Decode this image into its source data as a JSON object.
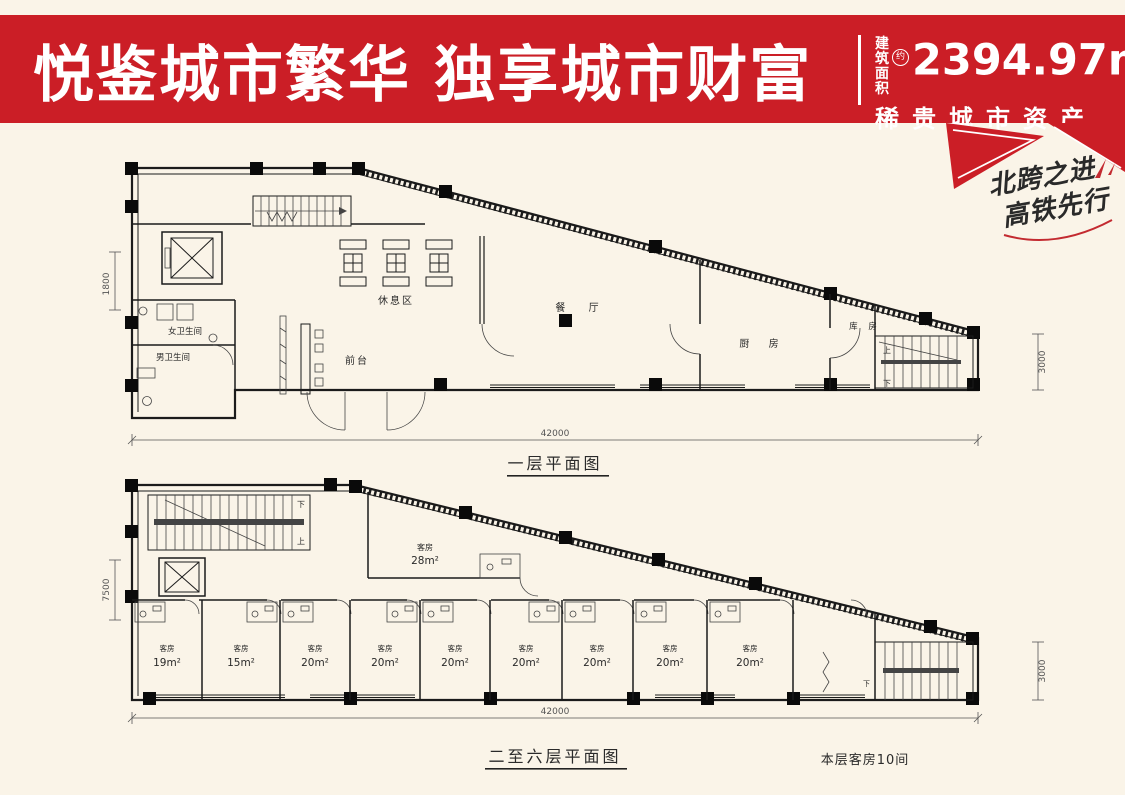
{
  "page": {
    "background": "#faf4e8"
  },
  "header": {
    "background": "#cb1e26",
    "title": "悦鉴城市繁华 独享城市财富",
    "area_label_top": "建筑",
    "area_label_bottom": "面积",
    "area_approx_badge": "约",
    "area_value": "2394.97m",
    "area_exponent": "2",
    "tagline": "稀贵城市资产"
  },
  "ribbon": {
    "color": "#c32a30",
    "line1": "北跨之进",
    "line2": "高铁先行"
  },
  "plan1": {
    "caption": "一层平面图",
    "dim_bottom": "42000",
    "dim_left": "1800",
    "dim_right": "3000",
    "labels": {
      "rest_area": "休息区",
      "dining": "餐 厅",
      "kitchen": "厨 房",
      "storage": "库 房",
      "front_desk": "前台",
      "women_wc": "女卫生间",
      "men_wc": "男卫生间",
      "up": "上",
      "down": "下"
    }
  },
  "plan2": {
    "caption": "二至六层平面图",
    "note": "本层客房10间",
    "dim_bottom": "42000",
    "dim_left": "7500",
    "dim_right": "3000",
    "room_label": "客房",
    "special_room": {
      "label": "客房",
      "area": "28m²"
    },
    "rooms": [
      {
        "area": "19m²"
      },
      {
        "area": "15m²"
      },
      {
        "area": "20m²"
      },
      {
        "area": "20m²"
      },
      {
        "area": "20m²"
      },
      {
        "area": "20m²"
      },
      {
        "area": "20m²"
      },
      {
        "area": "20m²"
      },
      {
        "area": "20m²"
      }
    ],
    "labels": {
      "up": "上",
      "down": "下"
    }
  }
}
